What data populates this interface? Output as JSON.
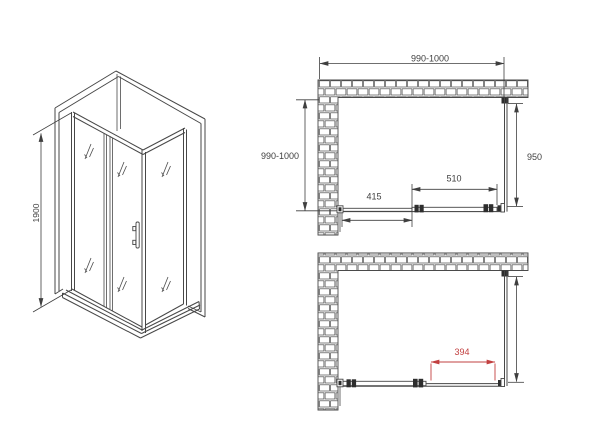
{
  "drawing": {
    "isometric_view": {
      "height_mm": "1900"
    },
    "top_plan_view": {
      "overall_width_mm": "990-1000",
      "overall_depth_mm": "990-1000",
      "side_panel_mm": "950",
      "sliding_door_mm": "510",
      "fixed_panel_mm": "415"
    },
    "bottom_plan_view": {
      "door_opening_mm": "394"
    }
  },
  "colors": {
    "line": "#474747",
    "accent_red": "#c24040",
    "background": "#ffffff"
  }
}
